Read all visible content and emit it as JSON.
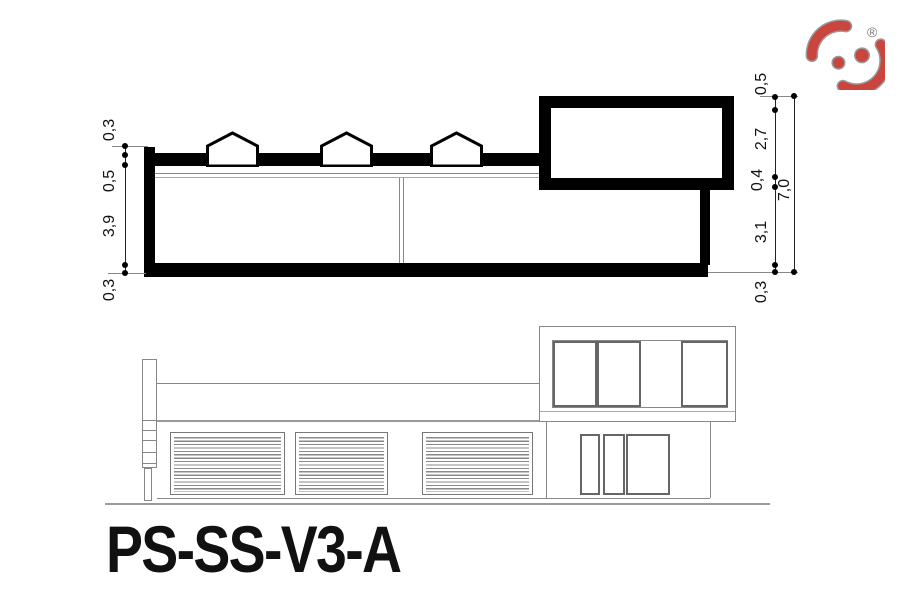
{
  "title": "PS-SS-V3-A",
  "logo": {
    "registered_symbol": "®",
    "accent_color": "#c9453d"
  },
  "dims": {
    "left": [
      "0,3",
      "0,5",
      "3,9",
      "0,3"
    ],
    "right": [
      "0,5",
      "2,7",
      "0,4",
      "3,1",
      "0,3"
    ],
    "right_total": "7,0"
  }
}
